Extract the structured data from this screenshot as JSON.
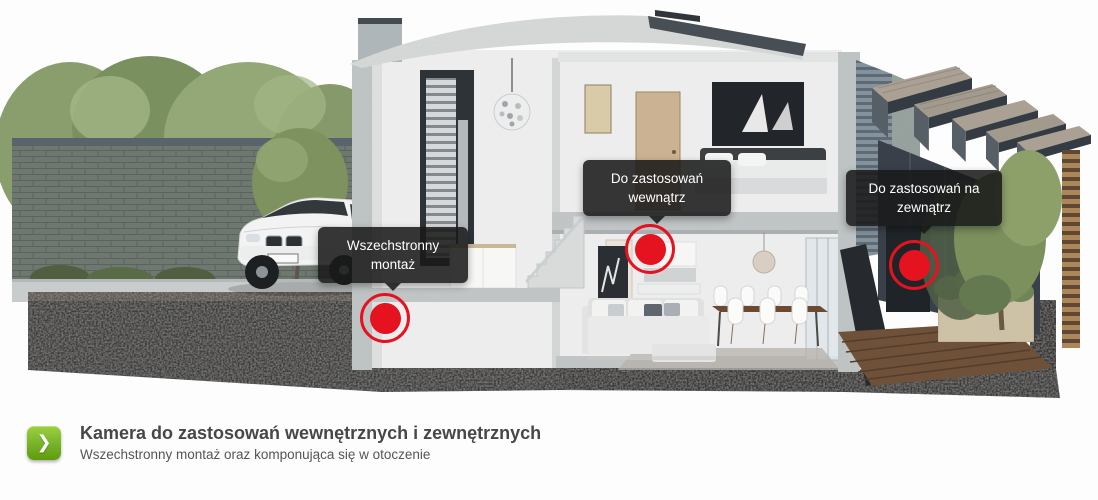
{
  "banner": {
    "tooltips": [
      {
        "name": "mount",
        "text": "Wszechstronny montaż",
        "lines": [
          "Wszechstronny",
          "montaż"
        ]
      },
      {
        "name": "indoor",
        "text": "Do zastosowań wewnątrz",
        "lines": [
          "Do zastosowań",
          "wewnątrz"
        ]
      },
      {
        "name": "outdoor",
        "text": "Do zastosowań na zewnątrz",
        "lines": [
          "Do zastosowań na",
          "zewnątrz"
        ]
      }
    ],
    "hotspot_count": 3
  },
  "footer": {
    "title": "Kamera do zastosowań wewnętrznych i zewnętrznych",
    "subtitle": "Wszechstronny montaż oraz komponująca się w otoczenie",
    "arrow_icon": "❯"
  },
  "colors": {
    "marker_red": "#e4131f",
    "accent_green_light": "#9ed03e",
    "accent_green_dark": "#5f9b0a",
    "tooltip_bg": "rgba(25,25,25,0.87)",
    "title_text": "#474747",
    "subtitle_text": "#555555"
  }
}
